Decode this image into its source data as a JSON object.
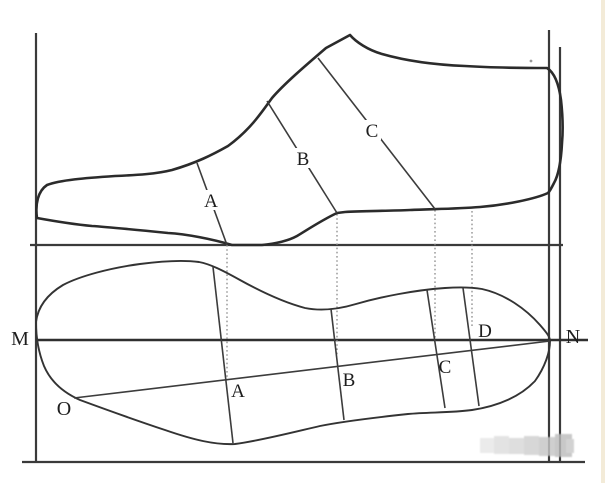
{
  "diagram": {
    "upper_view": {
      "label_a": "A",
      "label_b": "B",
      "label_c": "C"
    },
    "sole_view": {
      "label_a": "A",
      "label_b": "B",
      "label_c": "C",
      "label_d": "D"
    },
    "reference_points": {
      "m": "M",
      "n": "N",
      "o": "O"
    },
    "colors": {
      "background": "#ffffff",
      "outline": "#2b2b2b",
      "frame": "#3a3a3a",
      "projection_dotted": "#8a8a8a",
      "edge_strip": "#f2e9d4",
      "watermark_grays": [
        "#e7e7e7",
        "#dedede",
        "#d7d7d7",
        "#cfcfcf",
        "#c5c5c5",
        "#bcbcbc",
        "#c9c9c9"
      ]
    }
  }
}
